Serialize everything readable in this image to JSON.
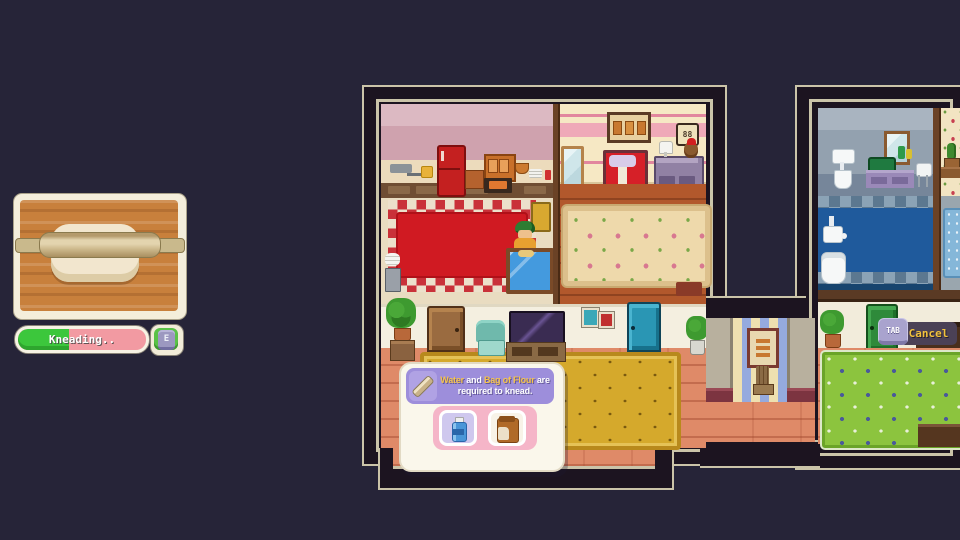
{
  "ui": {
    "minigame": {
      "action_label": "Kneading..",
      "progress_percent": 40,
      "key_hint": "E",
      "icon": "rolling-pin-dough-illustration"
    },
    "requirement_tooltip": {
      "icon": "rolling-pin-icon",
      "seg1": "Water",
      "seg2": " and ",
      "seg3": "Bag of Flour",
      "seg4": " are required to knead.",
      "slots": [
        {
          "item": "Water",
          "icon": "water-bottle-icon"
        },
        {
          "item": "Bag of Flour",
          "icon": "flour-bag-icon"
        }
      ]
    },
    "cancel_button": {
      "key": "TAB",
      "label": "Cancel"
    }
  },
  "scene": {
    "bedroom_clock": "88",
    "rooms": [
      "kitchen",
      "bedroom",
      "living-room",
      "hallway",
      "bathroom",
      "plant-room",
      "dining-room"
    ]
  },
  "colors": {
    "background": "#262438",
    "outline_dark": "#1c1420",
    "outline_tan": "#cbc4a9",
    "progress_green": "#3cc73c",
    "progress_pink": "#f29aa2",
    "tooltip_purple": "#9d8edb",
    "highlight_yellow": "#f6c44a",
    "cancel_bg": "#4b4156"
  }
}
